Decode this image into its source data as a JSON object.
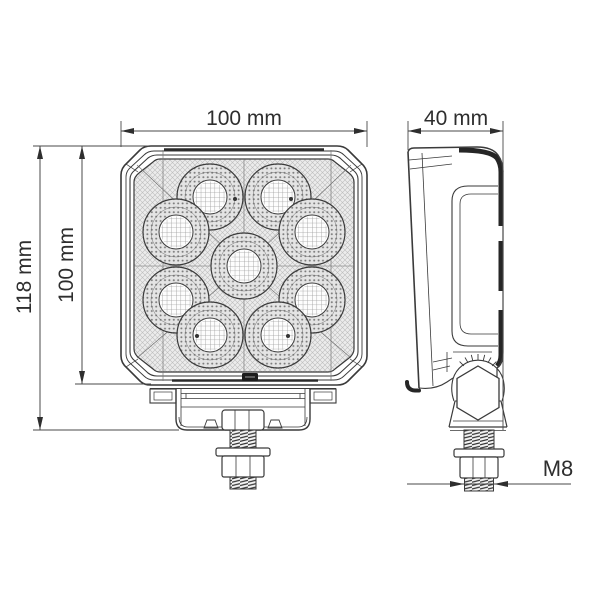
{
  "canvas": {
    "background": "#ffffff"
  },
  "diagram": {
    "type": "technical-dimension-drawing",
    "views": {
      "front": {
        "name": "lamp-front-view",
        "led_count": 9
      },
      "side": {
        "name": "lamp-side-profile-view"
      }
    },
    "dimensions": {
      "front_width": "100 mm",
      "total_height": "118 mm",
      "body_height": "100 mm",
      "depth": "40 mm",
      "thread": "M8"
    },
    "colors": {
      "line": "#3a3a3a",
      "dim_line": "#4a4a4a",
      "dark_fill": "#262626",
      "text": "#2e2e2e"
    }
  }
}
